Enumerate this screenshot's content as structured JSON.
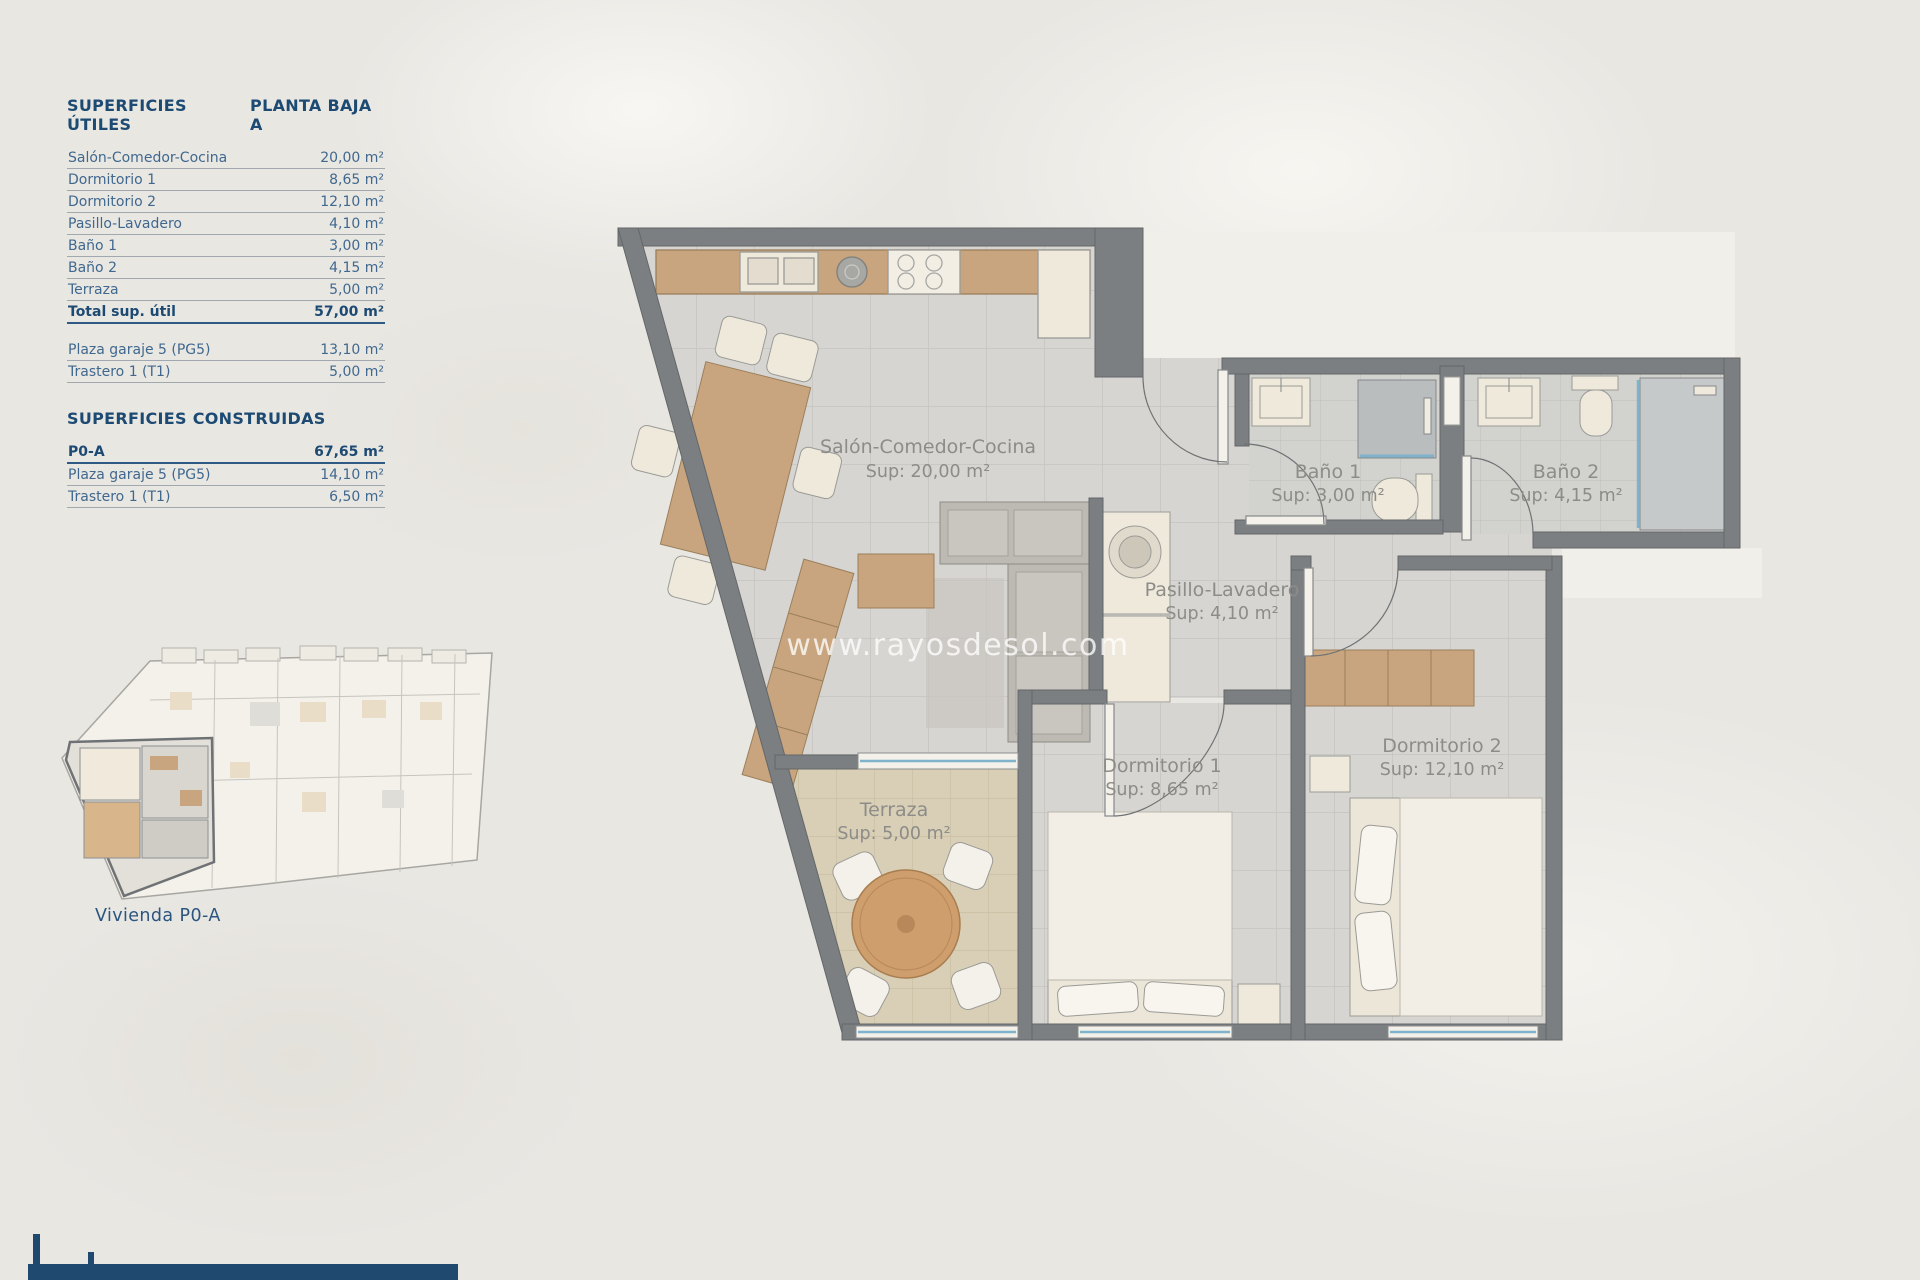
{
  "surfaces_utiles": {
    "title": "SUPERFICIES ÚTILES",
    "subtitle": "PLANTA BAJA A",
    "rows": [
      {
        "label": "Salón-Comedor-Cocina",
        "value": "20,00 m²"
      },
      {
        "label": "Dormitorio 1",
        "value": "8,65 m²"
      },
      {
        "label": "Dormitorio 2",
        "value": "12,10 m²"
      },
      {
        "label": "Pasillo-Lavadero",
        "value": "4,10 m²"
      },
      {
        "label": "Baño 1",
        "value": "3,00 m²"
      },
      {
        "label": "Baño 2",
        "value": "4,15 m²"
      },
      {
        "label": "Terraza",
        "value": "5,00 m²"
      }
    ],
    "total": {
      "label": "Total sup. útil",
      "value": "57,00 m²"
    },
    "extras": [
      {
        "label": "Plaza garaje 5 (PG5)",
        "value": "13,10 m²"
      },
      {
        "label": "Trastero 1 (T1)",
        "value": "5,00 m²"
      }
    ]
  },
  "surfaces_construidas": {
    "title": "SUPERFICIES CONSTRUIDAS",
    "rows": [
      {
        "label": "P0-A",
        "value": "67,65 m²"
      },
      {
        "label": "Plaza garaje 5 (PG5)",
        "value": "14,10 m²"
      },
      {
        "label": "Trastero 1 (T1)",
        "value": "6,50 m²"
      }
    ]
  },
  "mini_plan": {
    "caption": "Vivienda P0-A"
  },
  "floor_plan": {
    "watermark": "www.rayosdesol.com",
    "rooms": [
      {
        "name": "Salón-Comedor-Cocina",
        "area": "Sup: 20,00 m²"
      },
      {
        "name": "Baño 1",
        "area": "Sup: 3,00 m²"
      },
      {
        "name": "Baño 2",
        "area": "Sup: 4,15 m²"
      },
      {
        "name": "Pasillo-Lavadero",
        "area": "Sup: 4,10 m²"
      },
      {
        "name": "Dormitorio 1",
        "area": "Sup: 8,65 m²"
      },
      {
        "name": "Dormitorio 2",
        "area": "Sup: 12,10 m²"
      },
      {
        "name": "Terraza",
        "area": "Sup: 5,00 m²"
      }
    ],
    "colors": {
      "wall": "#7c7f81",
      "floor": "#d6d5d1",
      "terrace": "#d9cfb6",
      "wood": "#c8a57e",
      "glass": "#7fb3cc",
      "navy": "#20496f"
    }
  }
}
